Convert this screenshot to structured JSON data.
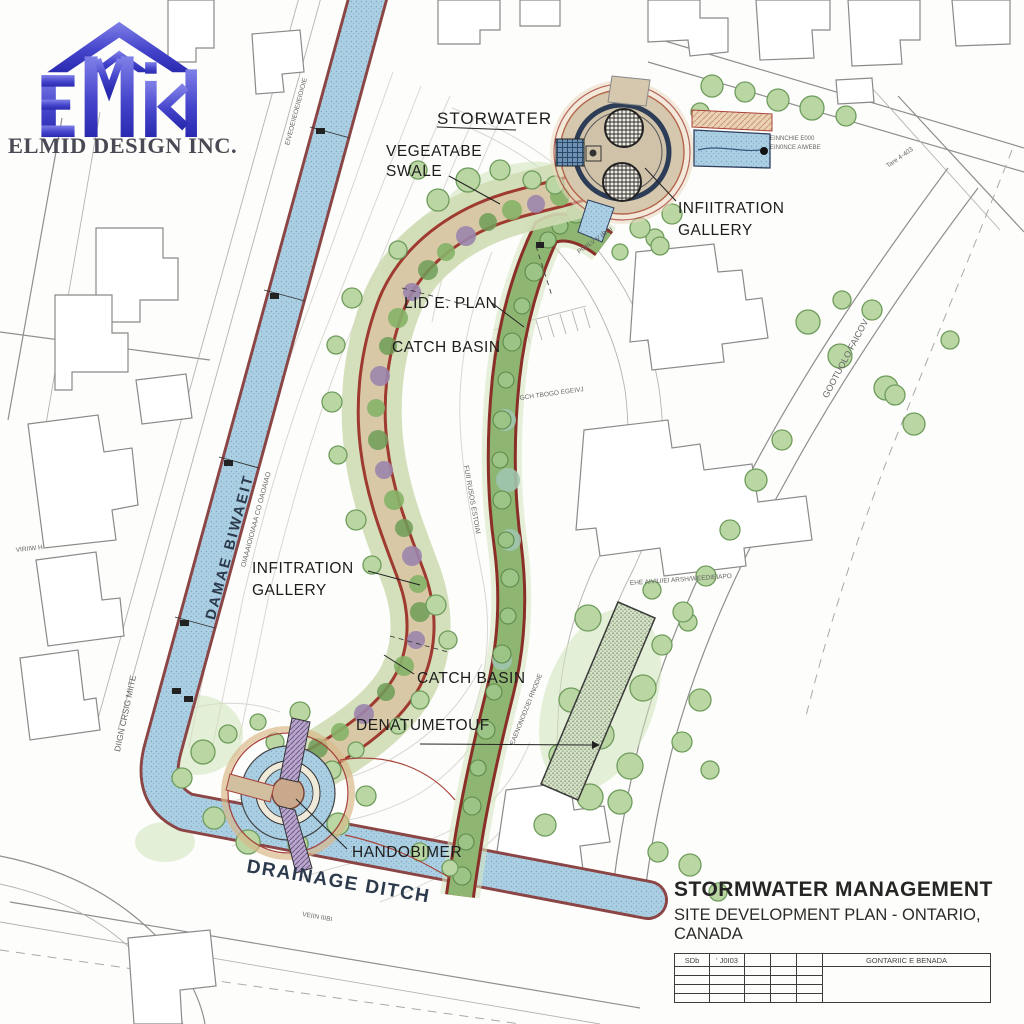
{
  "logo": {
    "company": "ELMID DESIGN INC."
  },
  "plan_labels": {
    "stormwater": "STORWATER",
    "vegetated_swale_1": "VEGEATABE",
    "vegetated_swale_2": "SWALE",
    "infiltration_gallery_ne_1": "INFIITRATION",
    "infiltration_gallery_ne_2": "GALLERY",
    "lid_plan": "LID E. PLAN",
    "catch_basin_upper": "CATCH BASIN",
    "infiltration_gallery_w_1": "INFITRATION",
    "infiltration_gallery_w_2": "GALLERY",
    "catch_basin_lower": "CATCH BASIN",
    "denuded_note": "DENATUMETOUF",
    "hand_chamber": "HANDOBIMER",
    "drainage_ditch_bottom": "DRAINAGE DITCH",
    "drainage_ditch_left": "DAMAE BIWAEIT"
  },
  "street_labels": {
    "left": "DIIGN CRSIG MIITE",
    "right": "GOOTUOLO FAICOV"
  },
  "small_notes": {
    "channel_top": "EIVEOEIIEOEIIEIOIOIE",
    "ditch_left_small": "OIAAAIOIOIAAA CO OAOAIAO",
    "inlet_ne_1": "EINNCHIE E000",
    "inlet_ne_2": "EIN0NCE AIWEBE",
    "tare": "Tare 4-403",
    "swale_station": "POIILV V IBOI",
    "driveway": "GCH TBOGO EGEIVJ",
    "strip_station": "FUII RUSOS ESTOIAI",
    "residences": "EHE AIVIUIEI ARSH/WEEDIEIAPO",
    "bed_station": "EAENONODZIEI RNODIE",
    "house_left": "VIRIIW H",
    "ditch_small": "VEIIN IIIBI"
  },
  "title_block": {
    "title": "STORMWATER MANAGEMENT",
    "subtitle": "SITE DEVELOPMENT PLAN - ONTARIO, CANADA",
    "headers": [
      "SDb",
      "' J0I03",
      "",
      "",
      "",
      "GONTARIIC E BENADA"
    ]
  },
  "colors": {
    "water": "#abcfe3",
    "water_edge": "#8b4545",
    "swale_green": "#8fbb72",
    "path_tan": "#d8c8a6",
    "swale_edge_red": "#9e3a30",
    "plaza_ring": "#2e3d57",
    "logo_blue": "#4040c8",
    "contour": "#d9d7d1",
    "tree_fill": "#b9d6a3",
    "tree_stroke": "#6f9c5c",
    "shrub_purple": "#9b85ad",
    "title_text": "#222222"
  }
}
